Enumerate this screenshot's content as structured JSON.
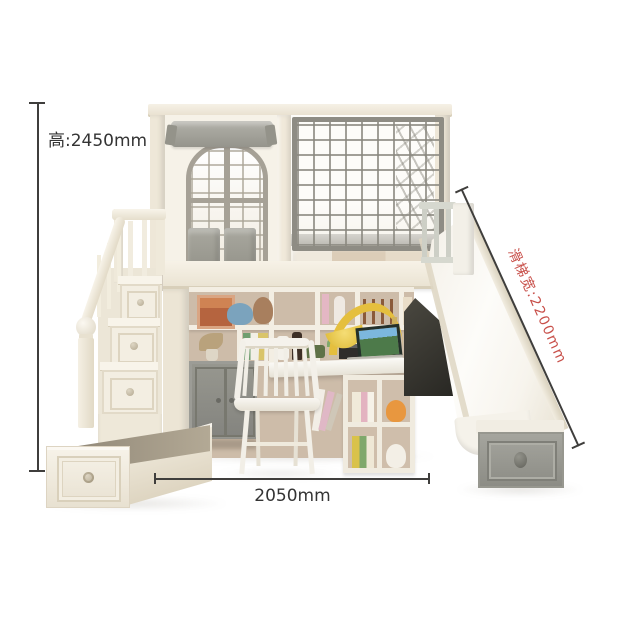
{
  "annotations": {
    "height_label": "高:2450mm",
    "width_label": "2050mm",
    "slide_label": "滑梯宽:2200mm"
  },
  "colors": {
    "dimension_line": "#3f3e3c",
    "dimension_text": "#343434",
    "slide_label_text": "#c8504a",
    "frame_cream": "#f1ebdf",
    "hardware_gray": "#8e8c84",
    "cabinet_gray": "#8e8e8a",
    "shelf_back_tan": "#cdbca9"
  }
}
